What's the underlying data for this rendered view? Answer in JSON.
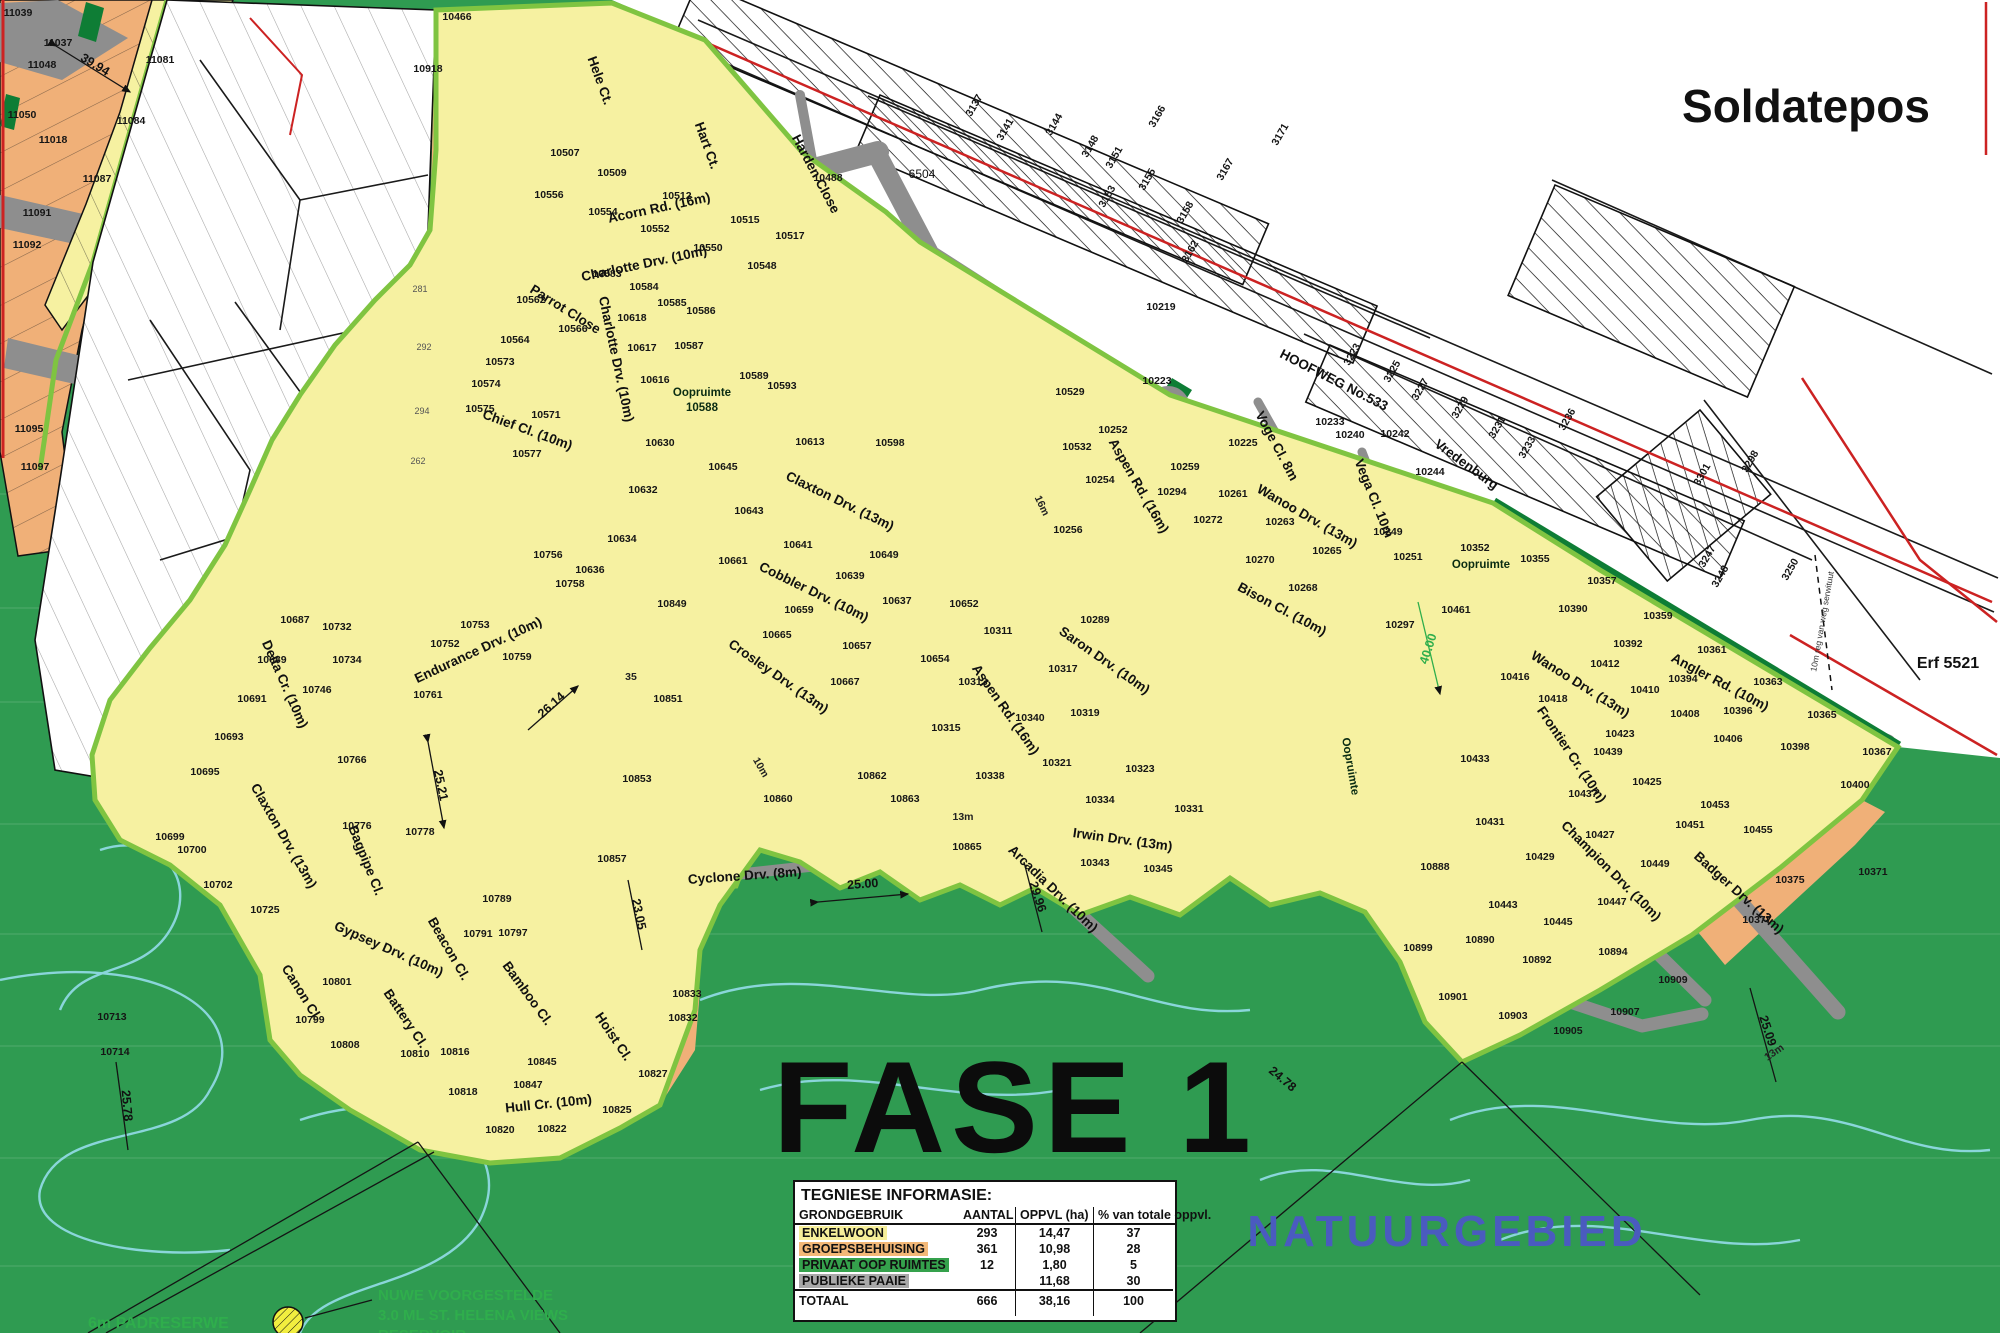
{
  "labels": {
    "soldatepos": "Soldatepos",
    "fase": "FASE 1",
    "natuurgebied": "NATUURGEBIED",
    "erf": "Erf 5521",
    "land": "6504",
    "oop": "Oopruimte",
    "oopnum": "10588",
    "oopnum2": "10352",
    "padreserwe": "6m PADRESERWE",
    "res1": "NUWE VOORGESTELDE",
    "res2": "3.0 ML ST. HELENA VIEWS",
    "res3": "RESERVOIR",
    "serwituut": "10m reg van weg serwituut"
  },
  "table": {
    "title": "TEGNIESE INFORMASIE:",
    "cols": [
      "GRONDGEBRUIK",
      "AANTAL",
      "OPPVL (ha)",
      "% van totale oppvl."
    ],
    "rows": [
      {
        "label": "ENKELWOON",
        "aantal": "293",
        "oppvl": "14,47",
        "pct": "37"
      },
      {
        "label": "GROEPSBEHUISING",
        "aantal": "361",
        "oppvl": "10,98",
        "pct": "28"
      },
      {
        "label": "PRIVAAT OOP RUIMTES",
        "aantal": "12",
        "oppvl": "1,80",
        "pct": "5"
      },
      {
        "label": "PUBLIEKE PAAIE",
        "aantal": "",
        "oppvl": "11,68",
        "pct": "30"
      }
    ],
    "total": {
      "label": "TOTAAL",
      "aantal": "666",
      "oppvl": "38,16",
      "pct": "100"
    }
  },
  "map": {
    "streets": [
      "Acorn Rd. (16m)",
      "Harden Close",
      "Hele Ct.",
      "Hart Ct.",
      "Charlotte Drv. (10m)",
      "Parrot Close",
      "Chief Cl. (10m)",
      "Claxton Drv. (13m)",
      "Cobbler Drv. (10m)",
      "Crosley Drv. (13m)",
      "Cyclone Drv. (8m)",
      "Irwin Drv. (13m)",
      "Arcadia Drv. (10m)",
      "Saron Drv. (10m)",
      "Aspen Rd. (16m)",
      "Wanoo Drv. (13m)",
      "Voge Cl. 8m",
      "Vega Cl. 10m",
      "Bison Cl. (10m)",
      "Angler Rd. (10m)",
      "Frontier Cr. (10m)",
      "Badger Drv. (13m)",
      "Champion Drv. (10m)",
      "Delta Cr. (10m)",
      "Endurance Drv. (10m)",
      "Bagpipe Cl.",
      "Gypsey Drv. (10m)",
      "Canon Cl.",
      "Battery Cl.",
      "Beacon Cl.",
      "Bamboo Cl.",
      "Hoist Cl.",
      "Hull Cr. (10m)",
      "HOOFWEG No.533",
      "Vredenburg"
    ],
    "dims": [
      "39.94",
      "26.14",
      "25.21",
      "23.05",
      "25.00",
      "29.96",
      "24.78",
      "25.09",
      "25.78",
      "40.00"
    ],
    "marks": [
      "13m",
      "13m",
      "16m",
      "10m",
      "35"
    ],
    "pnw": [
      "11039",
      "11037",
      "11048",
      "11050",
      "11018",
      "11081",
      "11084",
      "11087",
      "11091",
      "11092",
      "11095",
      "11097"
    ],
    "ptw": [
      "281",
      "292",
      "294",
      "262"
    ],
    "psp": [
      "3137",
      "3141",
      "3144",
      "3148",
      "3151",
      "3153",
      "3155",
      "3158",
      "3162",
      "3166",
      "3167",
      "3171",
      "3223",
      "3225",
      "3227",
      "3229",
      "3231",
      "3233",
      "3236",
      "3250",
      "3298",
      "3301",
      "3247",
      "3248"
    ],
    "pf": [
      "10466",
      "10918",
      "10507",
      "10509",
      "10512",
      "10515",
      "10517",
      "10488",
      "10556",
      "10554",
      "10552",
      "10550",
      "10548",
      "10583",
      "10562",
      "10564",
      "10566",
      "10573",
      "10574",
      "10571",
      "10575",
      "10577",
      "10584",
      "10585",
      "10586",
      "10618",
      "10617",
      "10616",
      "10587",
      "10589",
      "10593",
      "10598",
      "10613",
      "10630",
      "10632",
      "10634",
      "10636",
      "10645",
      "10643",
      "10641",
      "10639",
      "10637",
      "10649",
      "10661",
      "10659",
      "10657",
      "10665",
      "10667",
      "10756",
      "10758",
      "10849",
      "10851",
      "10853",
      "10857",
      "10860",
      "10862",
      "10863",
      "10865",
      "10652",
      "10654",
      "10311",
      "10313",
      "10315",
      "10317",
      "10319",
      "10321",
      "10323",
      "10338",
      "10340",
      "10334",
      "10331",
      "10343",
      "10345",
      "10289",
      "10219",
      "10252",
      "10254",
      "10256",
      "10529",
      "10532",
      "10259",
      "10261",
      "10263",
      "10265",
      "10294",
      "10272",
      "10270",
      "10268",
      "10223",
      "10225",
      "10233",
      "10240",
      "10242",
      "10244",
      "10249",
      "10251",
      "10297",
      "10461",
      "10352",
      "10355",
      "10357",
      "10359",
      "10361",
      "10363",
      "10365",
      "10367",
      "10390",
      "10392",
      "10394",
      "10396",
      "10398",
      "10400",
      "10412",
      "10410",
      "10408",
      "10406",
      "10416",
      "10418",
      "10423",
      "10425",
      "10427",
      "10429",
      "10431",
      "10433",
      "10437",
      "10439",
      "10443",
      "10445",
      "10447",
      "10449",
      "10451",
      "10453",
      "10455",
      "10888",
      "10890",
      "10892",
      "10894",
      "10899",
      "10901",
      "10903",
      "10905",
      "10907",
      "10909",
      "10375",
      "10377",
      "10371",
      "10687",
      "10689",
      "10691",
      "10693",
      "10695",
      "10699",
      "10700",
      "10702",
      "10713",
      "10714",
      "10725",
      "10732",
      "10734",
      "10746",
      "10752",
      "10753",
      "10759",
      "10761",
      "10766",
      "10776",
      "10778",
      "10789",
      "10791",
      "10797",
      "10801",
      "10799",
      "10808",
      "10810",
      "10816",
      "10818",
      "10820",
      "10822",
      "10825",
      "10827",
      "10832",
      "10833",
      "10845",
      "10847"
    ]
  },
  "colors": {
    "background_green": "#2f9b51",
    "open_space_green": "#0e7d35",
    "boundary_lime": "#7fc441",
    "plot_yellow": "#f6f1a1",
    "plot_orange": "#f0b078",
    "road_gray": "#8e8e8e",
    "contour_cyan": "#8fd9e2",
    "roundabout_blue": "#4a7bc4",
    "boundary_red": "#cc2222",
    "special_plot_darkred": "#7f1d1d",
    "natuur_text_blue": "#4a5bbf",
    "reserve_text_green": "#2fae4c",
    "legend_enkelwoon": "#f6ef9a",
    "legend_groepsbehuising": "#f3b877",
    "legend_privaat_oop": "#35a14c",
    "legend_publieke_paaie": "#a8a8a8"
  }
}
